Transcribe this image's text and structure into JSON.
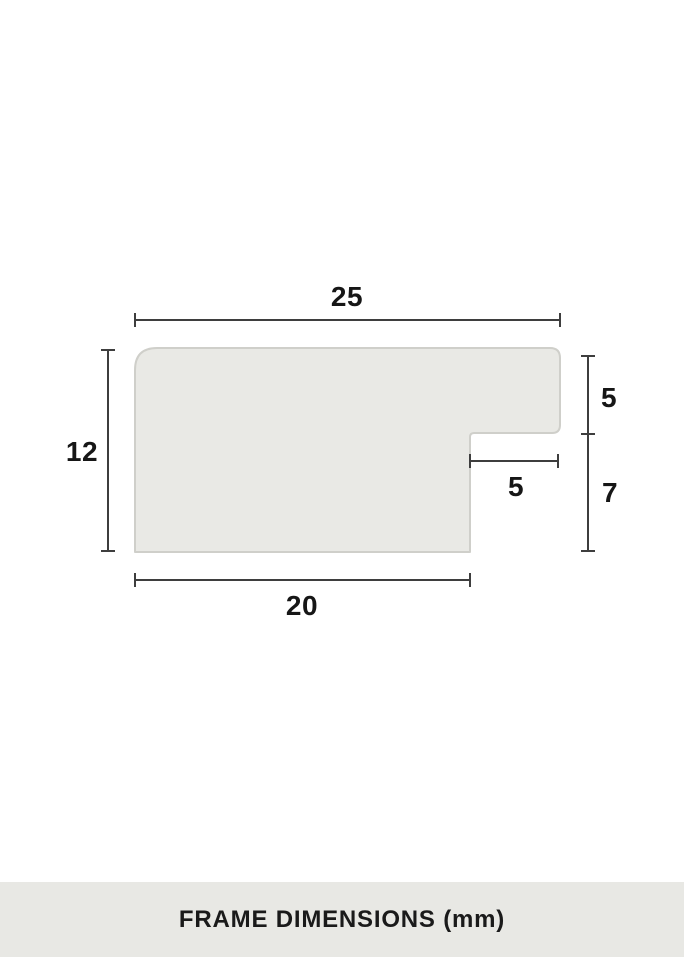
{
  "caption": {
    "label": "FRAME DIMENSIONS (mm)",
    "background": "#e8e8e4"
  },
  "diagram": {
    "subject": "frame-profile-cross-section",
    "unit": "mm",
    "dimensions": {
      "top_width": "25",
      "left_height": "12",
      "right_upper_height": "5",
      "right_lower_height": "7",
      "rabbet_width": "5",
      "bottom_width": "20"
    },
    "colors": {
      "profile_fill": "#e9e9e5",
      "profile_stroke": "#cfcfca",
      "dimension_line": "#3e3e3e",
      "label_text": "#161616"
    }
  }
}
